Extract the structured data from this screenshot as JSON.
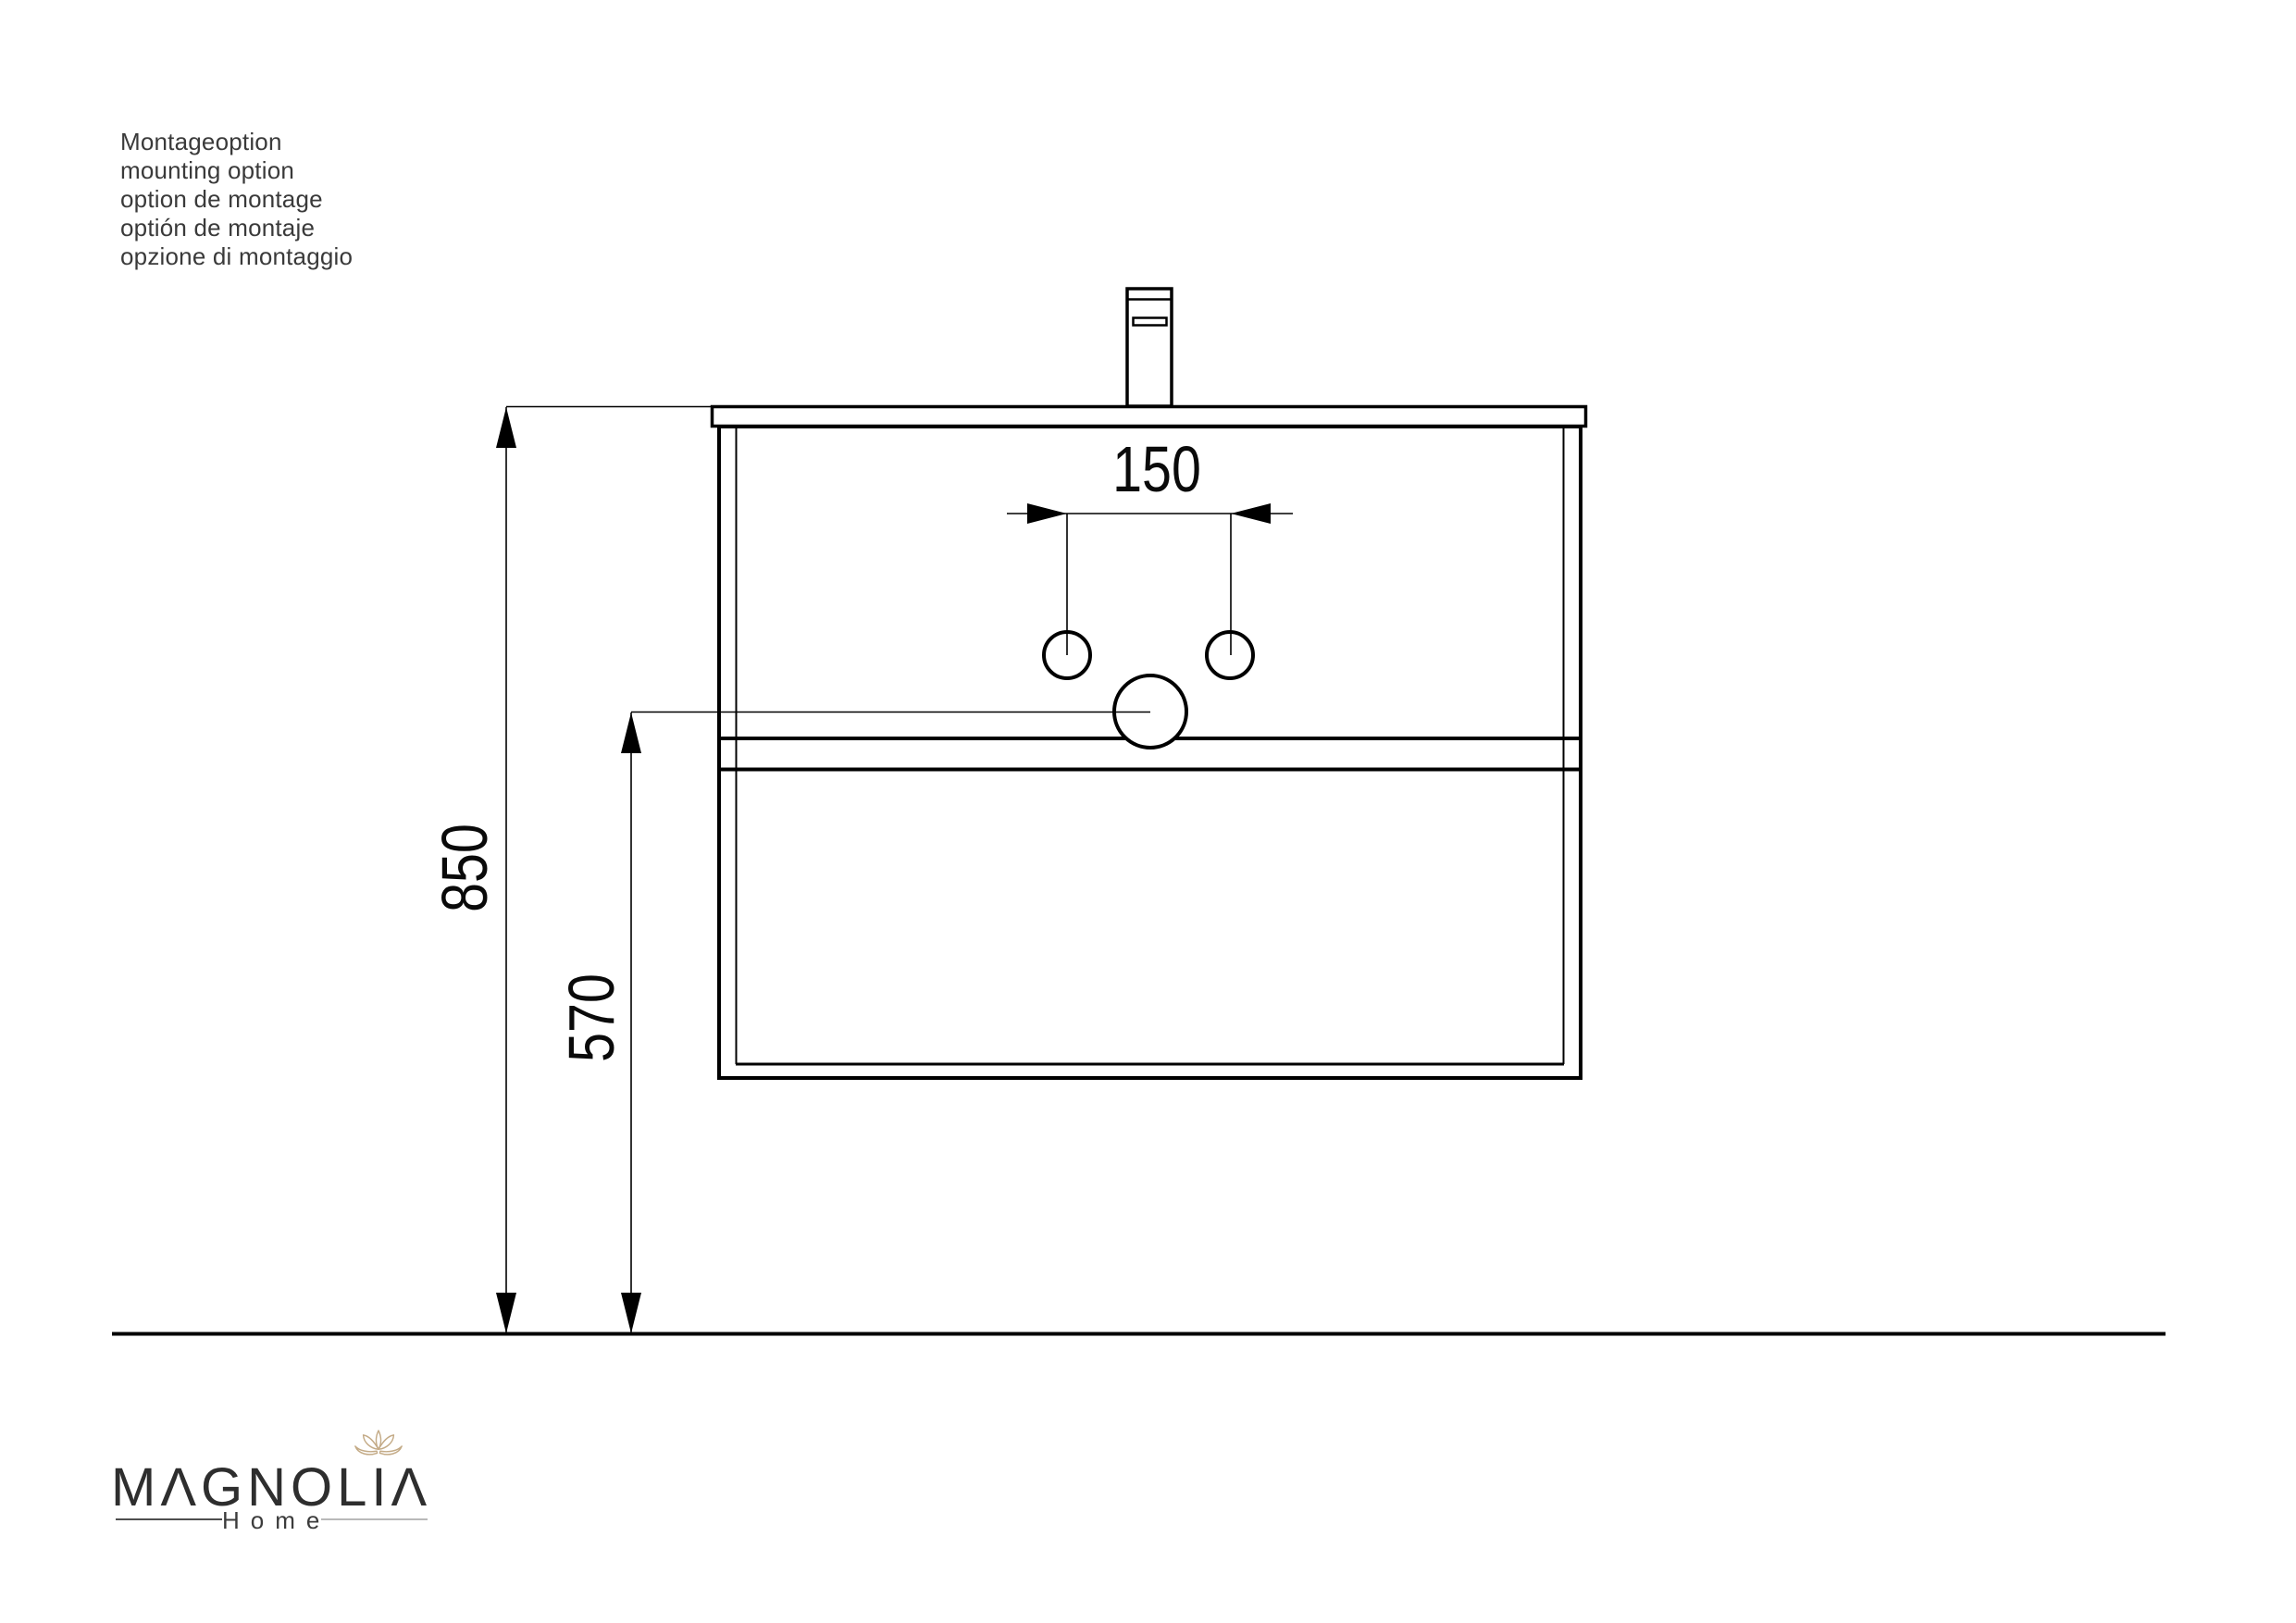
{
  "page": {
    "background": "#ffffff",
    "line_color": "#000000",
    "description": "Front-view mounting diagram of a wall-hung washbasin vanity with faucet, two fixing holes and drain hole, with heights above floor"
  },
  "notes": {
    "lines": [
      "Montageoption",
      "mounting option",
      "option de montage",
      "optión de montaje",
      "opzione di montaggio"
    ]
  },
  "dimensions": {
    "hole_spacing_mm": "150",
    "mounting_height_mm": "850",
    "drain_height_mm": "570"
  },
  "drawing": {
    "labels": {
      "dim_150": "150",
      "dim_850": "850",
      "dim_570": "570"
    }
  },
  "logo": {
    "brand": "MAGNOLIA",
    "brand_display": "MΛGNOLIΛ",
    "subtitle": "Home",
    "lotus_color": "#c4ab87"
  }
}
